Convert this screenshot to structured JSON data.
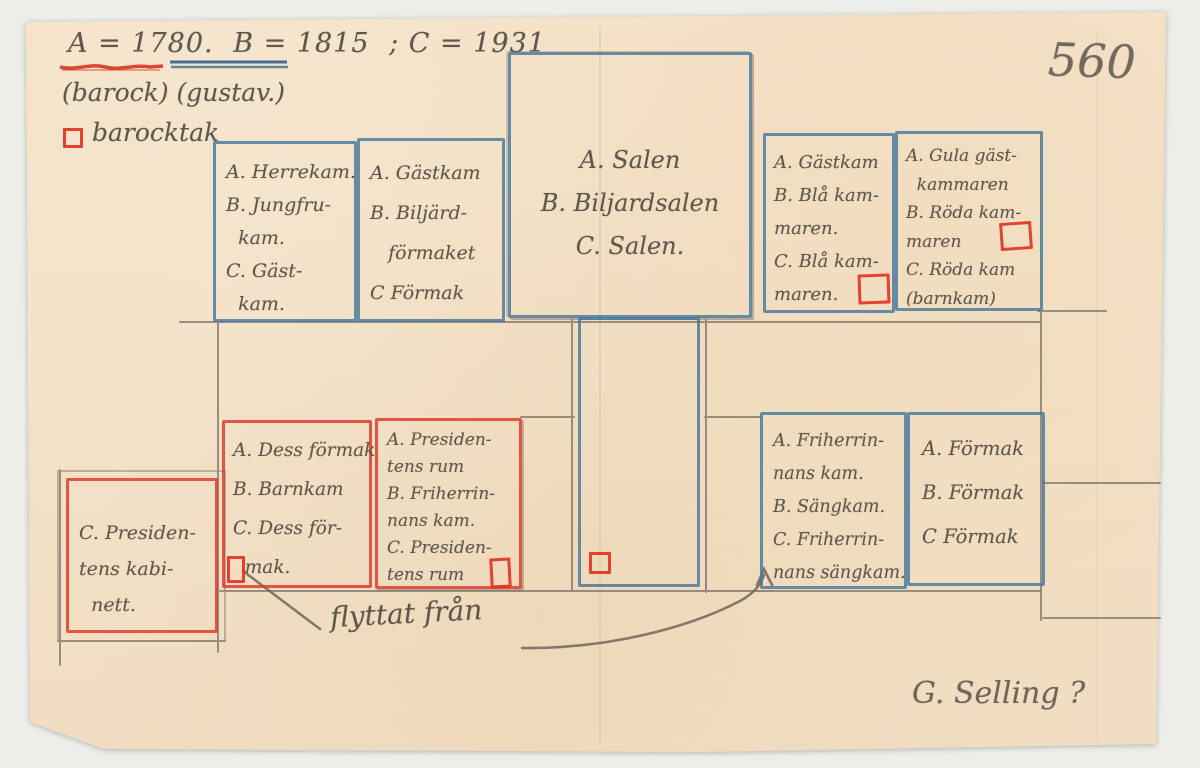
{
  "colors": {
    "paper": "#f4e2c7",
    "pencil": "#6e675d",
    "blue_pencil": "#46779d",
    "red_pencil": "#de3728"
  },
  "header": {
    "period_a": "A = 1780.",
    "period_b": "B = 1815",
    "period_c": "; C = 1931",
    "styles_note": "(barock) (gustav.)",
    "legend_symbol": "red-square",
    "legend_label": "barocktak",
    "page_number": "560"
  },
  "rooms": [
    {
      "id": "herrekammaren",
      "outline": "blue",
      "lines": [
        "A. Herrekam.",
        "B. Jungfru-",
        "  kam.",
        "C. Gäst-",
        "  kam."
      ]
    },
    {
      "id": "biljardformaket",
      "outline": "blue",
      "lines": [
        "A. Gästkam",
        "B. Biljärd-",
        "   förmaket",
        "C Förmak"
      ]
    },
    {
      "id": "salen",
      "outline": "blue",
      "lines": [
        "A. Salen",
        "B. Biljardsalen",
        "C. Salen."
      ]
    },
    {
      "id": "bla-kammaren",
      "outline": "blue",
      "has_marker": true,
      "lines": [
        "A. Gästkam",
        "B. Blå kam-",
        "maren.",
        "C. Blå kam-",
        "maren."
      ]
    },
    {
      "id": "roda-kammaren",
      "outline": "blue",
      "has_marker": true,
      "lines": [
        "A. Gula gäst-",
        "  kammaren",
        "B. Röda kam-",
        "maren",
        "C. Röda kam",
        "(barnkam)"
      ]
    },
    {
      "id": "presidentens-kabinett",
      "outline": "red",
      "lines": [
        "C. Presiden-",
        "tens kabi-",
        "  nett."
      ]
    },
    {
      "id": "dess-formak",
      "outline": "red",
      "has_marker": true,
      "lines": [
        "A. Dess förmak",
        "B. Barnkam",
        "C. Dess för-",
        "  mak."
      ]
    },
    {
      "id": "presidentens-rum",
      "outline": "red",
      "has_marker": true,
      "lines": [
        "A. Presiden-",
        "tens rum",
        "B. Friherrin-",
        "nans kam.",
        "C. Presiden-",
        "tens rum"
      ]
    },
    {
      "id": "friherrinnans-kam",
      "outline": "blue",
      "lines": [
        "A. Friherrin-",
        "nans kam.",
        "B. Sängkam.",
        "C. Friherrin-",
        "nans sängkam."
      ]
    },
    {
      "id": "formak",
      "outline": "blue",
      "lines": [
        "A. Förmak",
        "B. Förmak",
        "C Förmak"
      ]
    }
  ],
  "annotations": {
    "moved_from": "flyttat från",
    "attribution": "G. Selling ?"
  }
}
